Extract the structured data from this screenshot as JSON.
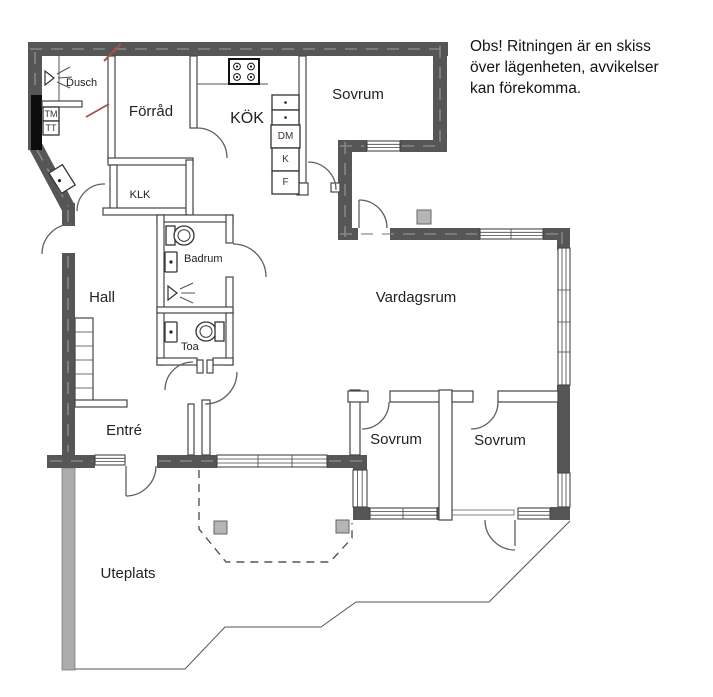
{
  "note": {
    "line1": "Obs! Ritningen är en skiss",
    "line2": "över lägenheten, avvikelser",
    "line3": "kan förekomma."
  },
  "labels": {
    "dusch": "Dusch",
    "forrad": "Förråd",
    "kok": "KÖK",
    "sovrum_top": "Sovrum",
    "klk": "KLK",
    "hall": "Hall",
    "badrum": "Badrum",
    "toa": "Toa",
    "vardagsrum": "Vardagsrum",
    "entre": "Entré",
    "sovrum_left": "Sovrum",
    "sovrum_right": "Sovrum",
    "uteplats": "Uteplats",
    "tm": "TM",
    "tt": "TT",
    "dm": "DM",
    "kyl": "K",
    "frys": "F"
  },
  "colors": {
    "wall": "#565656",
    "wall_hatch": "#8f8f8f",
    "line": "#4a4a4a",
    "patio_band": "#ababab",
    "post": "#b5b5b5",
    "accent_red": "#a85050",
    "text": "#222222"
  }
}
